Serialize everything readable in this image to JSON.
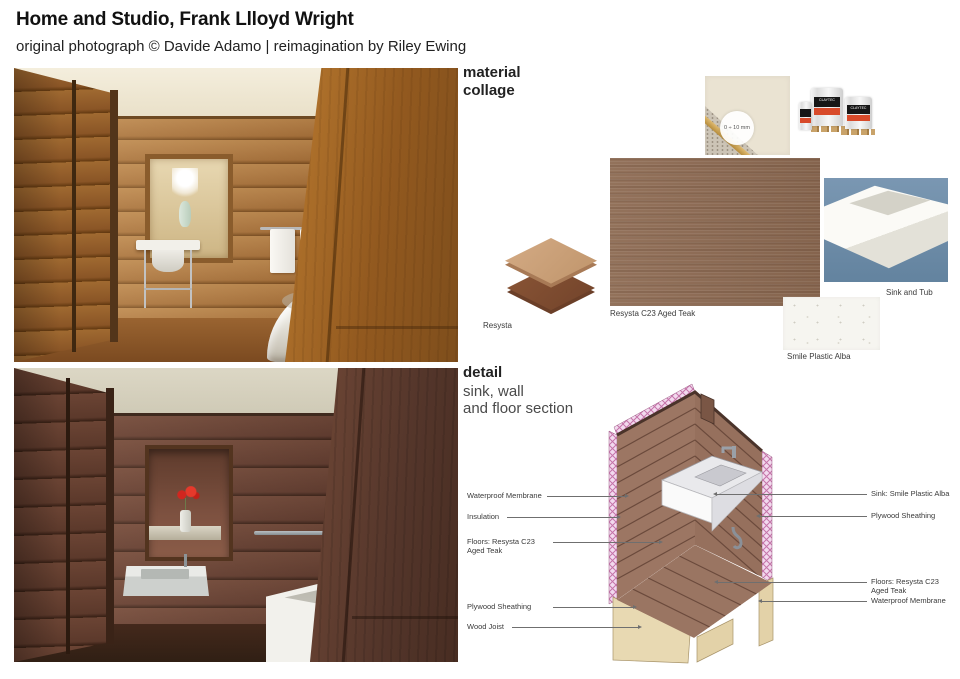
{
  "header": {
    "title": "Home and Studio, Frank Llloyd Wright",
    "subtitle": "original photograph © Davide Adamo | reimagination by Riley Ewing"
  },
  "photos": {
    "top_alt": "original photograph: wood-paneled bathroom with window, pedestal sink and freestanding tub",
    "bottom_alt": "reimagination render: dark wood-paneled bathroom with niche, wall-hung sink and rectangular tub"
  },
  "collage": {
    "heading_line1": "material",
    "heading_line2": "collage",
    "grain_badge": "0 ÷ 10 mm",
    "bucket_brand": "CLAYTEC",
    "labels": {
      "resysta": "Resysta",
      "resysta_swatch": "Resysta C23 Aged Teak",
      "sink_tub": "Sink and Tub",
      "smile": "Smile Plastic Alba"
    }
  },
  "detail": {
    "heading": "detail",
    "subheading_line1": "sink, wall",
    "subheading_line2": "and floor section",
    "labels_left": [
      "Waterproof Membrane",
      "Insulation",
      "Floors: Resysta C23 Aged Teak",
      "Plywood Sheathing",
      "Wood Joist"
    ],
    "labels_right": [
      "Sink: Smile Plastic Alba",
      "Plywood Sheathing",
      "Floors: Resysta C23 Aged Teak",
      "Waterproof Membrane"
    ]
  },
  "colors": {
    "wood_photo_top": "#b5793f",
    "wood_photo_bottom": "#6d4636",
    "resysta_teak": "#8d6b54",
    "insulation_pink": "#f2d9ee",
    "insulation_hatch": "#c573a8",
    "plywood_tan": "#e8d9b2",
    "sink_tub_bg": "#6f8faa",
    "clay_beige": "#eae3d2",
    "bucket_red": "#d84a2a"
  }
}
